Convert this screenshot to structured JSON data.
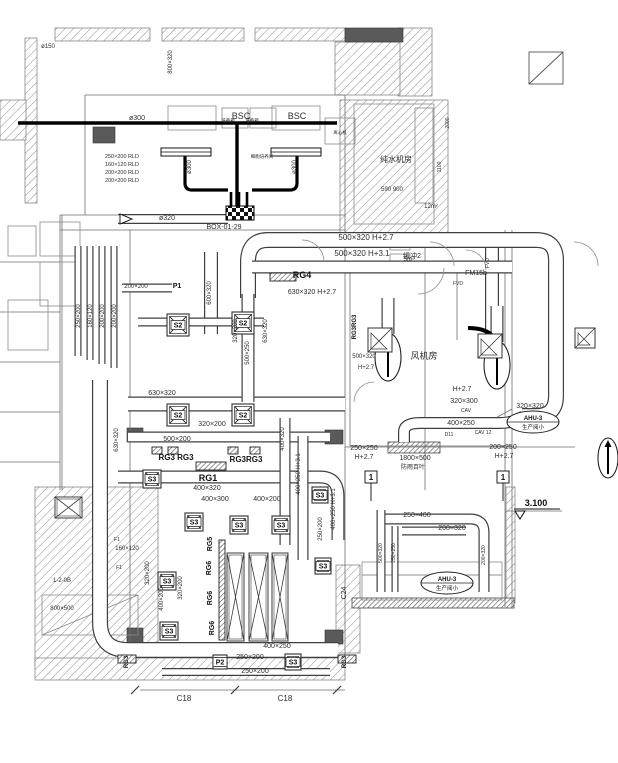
{
  "drawing": {
    "title": "HVAC duct layout plan",
    "colors": {
      "line": "#3f3f3f",
      "light_line": "#7d7d7d",
      "hatch": "#8f8f8f",
      "thick_black": "#000000",
      "solid_block": "#5a5a5a",
      "text": "#2d2d2d"
    },
    "texts": [
      [
        "ø150",
        48,
        48,
        6,
        0,
        0
      ],
      [
        "800×320",
        172,
        62,
        6,
        1,
        0
      ],
      [
        "ø300",
        137,
        120,
        7,
        0,
        0
      ],
      [
        "BSC",
        241,
        119,
        9,
        0,
        0
      ],
      [
        "BSC",
        297,
        119,
        9,
        0,
        0
      ],
      [
        "培养箱",
        228,
        122,
        4.5,
        0,
        0
      ],
      [
        "培养箱",
        252,
        122,
        4.5,
        0,
        0
      ],
      [
        "离心机",
        340,
        134,
        4.5,
        0,
        0
      ],
      [
        "细胞培养间",
        262,
        158,
        4.5,
        0,
        0
      ],
      [
        "ø300",
        191,
        167,
        6,
        1,
        0
      ],
      [
        "ø300",
        296,
        167,
        6,
        1,
        0
      ],
      [
        "250×200 RLD",
        122,
        158,
        5.5,
        0,
        0
      ],
      [
        "160×120 RLD",
        122,
        166,
        5.5,
        0,
        0
      ],
      [
        "200×200 RLD",
        122,
        174,
        5.5,
        0,
        0
      ],
      [
        "200×200 RLD",
        122,
        182,
        5.5,
        0,
        0
      ],
      [
        "纯水机房",
        396,
        162,
        8,
        0,
        0
      ],
      [
        "590 900",
        392,
        191,
        6,
        0,
        0
      ],
      [
        "2000",
        449,
        123,
        5,
        1,
        0
      ],
      [
        "1100",
        441,
        167,
        5,
        1,
        0
      ],
      [
        "ø320",
        167,
        220,
        7,
        0,
        0
      ],
      [
        "BOX-01-29",
        224,
        229,
        7,
        0,
        0
      ],
      [
        "500×320 H+2.7",
        366,
        240,
        8,
        0,
        0
      ],
      [
        "500×320 H+3.1",
        362,
        256,
        8,
        0,
        0
      ],
      [
        "缓冲2",
        412,
        258,
        7,
        0,
        0
      ],
      [
        "12m²",
        431,
        208,
        6,
        0,
        0
      ],
      [
        "5m²",
        409,
        261,
        6,
        0,
        0
      ],
      [
        "FM15b",
        476,
        275,
        7,
        0,
        0
      ],
      [
        "FVD",
        458,
        285,
        5,
        0,
        0
      ],
      [
        "FVD",
        489,
        263,
        5,
        1,
        0
      ],
      [
        "RG4",
        302,
        278,
        9,
        0,
        1
      ],
      [
        "630×320 H+2.7",
        312,
        294,
        7,
        0,
        0
      ],
      [
        "600×320",
        211,
        293,
        6,
        1,
        0
      ],
      [
        "630×320",
        267,
        331,
        6,
        1,
        0
      ],
      [
        "500×250",
        249,
        353,
        6,
        1,
        0
      ],
      [
        "320×200",
        237,
        331,
        6,
        1,
        0
      ],
      [
        "RG3RG3",
        356,
        327,
        6,
        1,
        1
      ],
      [
        "500×320",
        364,
        358,
        6,
        0,
        0
      ],
      [
        "H+2.7",
        366,
        369,
        6,
        0,
        0
      ],
      [
        "风机房",
        424,
        359,
        9,
        0,
        0
      ],
      [
        "250×200",
        80,
        316,
        6,
        1,
        0
      ],
      [
        "160×120",
        92,
        316,
        6,
        1,
        0
      ],
      [
        "200×200",
        104,
        316,
        6,
        1,
        0
      ],
      [
        "200×200",
        116,
        316,
        6,
        1,
        0
      ],
      [
        "200×200",
        136,
        288,
        6,
        0,
        0
      ],
      [
        "P1",
        177,
        288,
        7,
        0,
        1
      ],
      [
        "630×320",
        162,
        395,
        7,
        0,
        0
      ],
      [
        "320×200",
        212,
        426,
        7,
        0,
        0
      ],
      [
        "500×200",
        177,
        441,
        7,
        0,
        0
      ],
      [
        "630×320",
        118,
        440,
        6,
        1,
        0
      ],
      [
        "RG3 RG3",
        176,
        460,
        8,
        0,
        1
      ],
      [
        "RG3RG3",
        246,
        462,
        8,
        0,
        1
      ],
      [
        "RG1",
        208,
        481,
        9,
        0,
        1
      ],
      [
        "400×320",
        207,
        490,
        7,
        0,
        0
      ],
      [
        "400×300",
        215,
        501,
        7,
        0,
        0
      ],
      [
        "400×200",
        267,
        501,
        7,
        0,
        0
      ],
      [
        "400×320",
        284,
        439,
        6,
        1,
        0
      ],
      [
        "400×250 H+3.1",
        300,
        474,
        6,
        1,
        0
      ],
      [
        "400×250 H+3.1",
        335,
        509,
        6,
        1,
        0
      ],
      [
        "250×200",
        322,
        529,
        6,
        1,
        0
      ],
      [
        "H+2.7",
        462,
        391,
        7,
        0,
        0
      ],
      [
        "320×300",
        464,
        403,
        7,
        0,
        0
      ],
      [
        "CAV",
        466,
        412,
        5,
        0,
        0
      ],
      [
        "400×250",
        461,
        425,
        7,
        0,
        0
      ],
      [
        "D11",
        449,
        436,
        5,
        0,
        0
      ],
      [
        "CAV 12",
        483,
        434,
        5,
        0,
        0
      ],
      [
        "320×320",
        530,
        408,
        7,
        0,
        0
      ],
      [
        "200×250",
        503,
        449,
        7,
        0,
        0
      ],
      [
        "H+2.7",
        504,
        458,
        7,
        0,
        0
      ],
      [
        "250×250",
        364,
        450,
        7,
        0,
        0
      ],
      [
        "H+2.7",
        364,
        459,
        7,
        0,
        0
      ],
      [
        "1800×500",
        415,
        460,
        7,
        0,
        0
      ],
      [
        "防雨百叶",
        413,
        469,
        6,
        0,
        0
      ],
      [
        "3.100",
        536,
        506,
        9,
        0,
        1
      ],
      [
        "250×400",
        417,
        517,
        7,
        0,
        0
      ],
      [
        "200×320",
        452,
        530,
        7,
        0,
        0
      ],
      [
        "500×320",
        382,
        553,
        5,
        1,
        0
      ],
      [
        "250×250",
        395,
        553,
        5,
        1,
        0
      ],
      [
        "200×320",
        485,
        555,
        5,
        1,
        0
      ],
      [
        "160×120",
        127,
        550,
        6,
        0,
        0
      ],
      [
        "F1",
        117,
        541,
        5,
        0,
        0
      ],
      [
        "F1",
        119,
        569,
        5,
        0,
        0
      ],
      [
        "1-2-0B",
        62,
        582,
        6,
        0,
        0
      ],
      [
        "800×500",
        62,
        610,
        6,
        0,
        0
      ],
      [
        "320×200",
        149,
        573,
        6,
        1,
        0
      ],
      [
        "400×200",
        163,
        599,
        6,
        1,
        0
      ],
      [
        "320×200",
        182,
        588,
        6,
        1,
        0
      ],
      [
        "RG5",
        212,
        544,
        7,
        1,
        1
      ],
      [
        "RG6",
        211,
        568,
        7,
        1,
        1
      ],
      [
        "RG6",
        212,
        598,
        7,
        1,
        1
      ],
      [
        "RG6",
        214,
        628,
        7,
        1,
        1
      ],
      [
        "C24",
        346,
        593,
        7,
        1,
        0
      ],
      [
        "400×250",
        277,
        648,
        7,
        0,
        0
      ],
      [
        "250×200",
        250,
        659,
        7,
        0,
        0
      ],
      [
        "250×200",
        255,
        673,
        7,
        0,
        0
      ],
      [
        "RG3",
        128,
        662,
        6,
        1,
        1
      ],
      [
        "RG3",
        346,
        662,
        6,
        1,
        1
      ],
      [
        "C18",
        184,
        701,
        8,
        0,
        0
      ],
      [
        "C18",
        285,
        701,
        8,
        0,
        0
      ]
    ],
    "hatch_walls": [
      [
        55,
        28,
        95,
        13
      ],
      [
        162,
        28,
        82,
        13
      ],
      [
        255,
        28,
        90,
        13
      ],
      [
        398,
        28,
        34,
        68
      ],
      [
        335,
        42,
        65,
        53
      ],
      [
        340,
        100,
        108,
        138
      ],
      [
        25,
        38,
        12,
        165
      ],
      [
        0,
        100,
        26,
        40
      ],
      [
        35,
        487,
        123,
        178
      ],
      [
        35,
        658,
        310,
        22
      ],
      [
        336,
        565,
        24,
        88
      ],
      [
        506,
        487,
        9,
        116
      ]
    ],
    "dense_hatch": [
      [
        352,
        598,
        162,
        10
      ],
      [
        388,
        442,
        52,
        11
      ]
    ],
    "solid_blocks": [
      [
        345,
        28,
        58,
        14
      ],
      [
        93,
        127,
        22,
        16
      ],
      [
        127,
        428,
        16,
        14
      ],
      [
        325,
        430,
        18,
        14
      ],
      [
        127,
        628,
        16,
        16
      ],
      [
        325,
        630,
        18,
        14
      ]
    ],
    "thin_lines": [
      [
        85,
        95,
        345,
        95
      ],
      [
        85,
        95,
        85,
        215
      ],
      [
        60,
        215,
        345,
        215
      ],
      [
        60,
        230,
        345,
        230
      ],
      [
        130,
        230,
        130,
        655
      ],
      [
        345,
        95,
        345,
        230
      ],
      [
        345,
        230,
        345,
        655
      ],
      [
        130,
        655,
        345,
        655
      ],
      [
        350,
        268,
        512,
        268
      ],
      [
        350,
        268,
        350,
        446
      ],
      [
        350,
        446,
        512,
        446
      ],
      [
        457,
        268,
        457,
        340
      ],
      [
        505,
        230,
        505,
        607
      ],
      [
        512,
        230,
        512,
        607
      ],
      [
        425,
        232,
        425,
        490
      ],
      [
        60,
        215,
        60,
        490
      ],
      [
        62,
        215,
        62,
        490
      ],
      [
        0,
        262,
        60,
        262
      ],
      [
        0,
        312,
        60,
        312
      ],
      [
        0,
        362,
        60,
        362
      ],
      [
        0,
        412,
        60,
        412
      ],
      [
        0,
        462,
        60,
        462
      ],
      [
        140,
        690,
        345,
        690
      ],
      [
        345,
        447,
        575,
        447
      ],
      [
        506,
        511,
        562,
        511
      ],
      [
        512,
        409,
        492,
        420
      ],
      [
        362,
        575,
        502,
        575
      ]
    ],
    "dim_ticks": [
      [
        131,
        694,
        139,
        686
      ],
      [
        231,
        694,
        239,
        686
      ],
      [
        333,
        694,
        341,
        686
      ]
    ],
    "rects": [
      [
        168,
        106,
        48,
        24,
        0
      ],
      [
        222,
        108,
        26,
        20,
        0
      ],
      [
        250,
        108,
        26,
        20,
        0
      ],
      [
        272,
        106,
        48,
        24,
        0
      ],
      [
        325,
        118,
        30,
        26,
        0
      ],
      [
        415,
        108,
        18,
        95,
        0
      ],
      [
        40,
        222,
        40,
        34,
        0
      ],
      [
        8,
        226,
        28,
        30,
        0
      ],
      [
        40,
        262,
        40,
        44,
        0
      ],
      [
        8,
        300,
        40,
        50,
        0
      ],
      [
        390,
        236,
        20,
        14,
        0
      ],
      [
        390,
        254,
        20,
        14,
        0
      ],
      [
        362,
        562,
        140,
        38,
        0
      ],
      [
        42,
        595,
        96,
        40,
        1
      ],
      [
        354,
        104,
        80,
        120,
        0
      ]
    ],
    "ducts": [
      [
        "M248,298 L248,262 Q248,240 268,240 L536,240 Q556,240 556,260 L556,396 Q556,416 536,416 L522,416",
        16
      ],
      [
        "M492,248 L492,336",
        14
      ],
      [
        "M252,267 L512,267",
        13
      ],
      [
        "M78,246 L78,356",
        7
      ],
      [
        "M90,246 L90,360",
        7
      ],
      [
        "M102,246 L102,364",
        7
      ],
      [
        "M114,246 L114,368",
        7
      ],
      [
        "M100,380 L100,622 Q100,650 128,650 L338,650",
        16
      ],
      [
        "M162,672 L330,672",
        8
      ],
      [
        "M128,404 L345,404",
        15
      ],
      [
        "M128,437 L330,437",
        11
      ],
      [
        "M118,477 L320,477 Q338,477 338,496 L338,540",
        13
      ],
      [
        "M285,418 L285,545",
        11
      ],
      [
        "M303,436 L303,560",
        11
      ],
      [
        "M524,416 Q514,423 500,423 L420,423 Q404,423 404,432 L404,442",
        12
      ],
      [
        "M388,298 L388,334",
        13
      ],
      [
        "M497,306 L497,342",
        13
      ],
      [
        "M248,294 L248,402",
        13
      ],
      [
        "M122,288 L172,288",
        9
      ],
      [
        "M118,219 L228,219",
        10
      ],
      [
        "M211,252 L211,334",
        14
      ],
      [
        "M138,322 L264,322",
        9
      ],
      [
        "M378,519 L470,519 Q484,519 484,532 L484,592",
        11
      ],
      [
        "M402,531 L466,531",
        9
      ],
      [
        "M381,510 L381,592",
        9
      ],
      [
        "M395,526 L395,592",
        7
      ]
    ],
    "black_ducts": [
      [
        "M18,123 L337,123",
        3.4
      ],
      [
        "M237,123 L237,206",
        3.4
      ],
      [
        "M185,155 L185,183 Q185,190 192,190 L228,190",
        3.2
      ],
      [
        "M297,155 L297,183 Q297,190 290,190 L252,190",
        3.2
      ],
      [
        "M231,192 L231,206",
        2.6
      ],
      [
        "M239,192 L239,206",
        2.6
      ],
      [
        "M247,192 L247,206",
        2.6
      ],
      [
        "M468,328 Q497,328 497,350",
        4
      ]
    ],
    "slot_bars": [
      [
        161,
        148,
        50,
        8
      ],
      [
        271,
        148,
        50,
        8
      ]
    ],
    "checker": [
      226,
      206,
      28,
      14
    ],
    "diffusers": [
      [
        167,
        314,
        22,
        "S2"
      ],
      [
        232,
        312,
        22,
        "S2"
      ],
      [
        167,
        404,
        22,
        "S2"
      ],
      [
        232,
        404,
        22,
        "S2"
      ],
      [
        143,
        470,
        18,
        "S3"
      ],
      [
        185,
        513,
        18,
        "S3"
      ],
      [
        230,
        516,
        18,
        "S3"
      ],
      [
        272,
        516,
        18,
        "S3"
      ],
      [
        312,
        487,
        16,
        "S3"
      ],
      [
        315,
        558,
        16,
        "S3"
      ],
      [
        158,
        572,
        18,
        "S3"
      ],
      [
        160,
        622,
        18,
        "S3"
      ],
      [
        285,
        654,
        16,
        "S3"
      ],
      [
        213,
        655,
        14,
        "P2"
      ]
    ],
    "grilles": [
      [
        152,
        447,
        10,
        7
      ],
      [
        168,
        447,
        10,
        7
      ],
      [
        228,
        447,
        10,
        7
      ],
      [
        250,
        447,
        10,
        7
      ],
      [
        196,
        462,
        30,
        8
      ],
      [
        270,
        273,
        26,
        8
      ],
      [
        118,
        655,
        18,
        8
      ],
      [
        338,
        655,
        18,
        8
      ],
      [
        219,
        540,
        6,
        100
      ]
    ],
    "equipment_x": [
      [
        227,
        553,
        17,
        88
      ],
      [
        249,
        553,
        19,
        88
      ],
      [
        272,
        553,
        16,
        88
      ],
      [
        55,
        497,
        27,
        21
      ]
    ],
    "fans": [
      [
        388,
        357,
        13,
        24
      ],
      [
        497,
        365,
        13,
        24
      ],
      [
        608,
        458,
        10,
        20
      ]
    ],
    "corner_grilles": [
      [
        368,
        328,
        24
      ],
      [
        478,
        334,
        24
      ],
      [
        575,
        328,
        20
      ]
    ],
    "tags": [
      {
        "cx": 533,
        "cy": 422,
        "l1": "AHU-3",
        "l2": "生产阅小"
      },
      {
        "cx": 447,
        "cy": 583,
        "l1": "AHU-3",
        "l2": "生产阅小"
      }
    ],
    "section_marks": [
      [
        371,
        477,
        "1"
      ],
      [
        503,
        477,
        "1"
      ]
    ],
    "level_mark": {
      "x": 520,
      "y": 511
    },
    "keyplan": [
      529,
      52,
      34,
      32
    ],
    "arcs": [
      "M302,240 A22,22 0 0 1 324,262",
      "M430,242 A24,24 0 0 1 454,266",
      "M574,242 A24,24 0 0 1 598,266",
      "M444,268 A26,26 0 0 1 418,294",
      "M354,402 A20,20 0 0 1 374,382",
      "M466,250 A20,20 0 0 1 486,270"
    ]
  }
}
